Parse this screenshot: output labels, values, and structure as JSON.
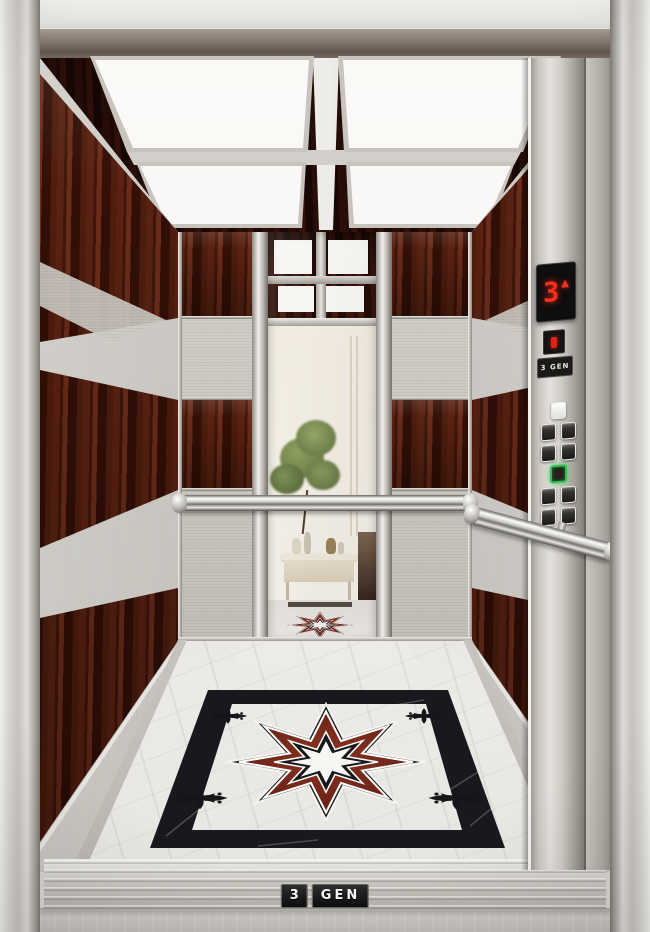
{
  "scene": {
    "description": "Luxury elevator cabin interior: mahogany and textured stainless panels, four-panel ceiling lights, center mirror reflecting a lobby with plant and console table, chrome handrails, marble floor with eight-point star medallion"
  },
  "brand": {
    "name": "3 GEN"
  },
  "cop": {
    "floor_display": {
      "floor": "3",
      "direction": "up",
      "direction_glyph": "▲",
      "color": "#ff2f1d"
    },
    "service_indicator": {
      "color": "#e02218"
    },
    "brand_plate": {
      "label": "3 GEN"
    },
    "buttons": {
      "highlight_color": "#2ec152",
      "layout": [
        "single-lit",
        "pair",
        "pair",
        "single-green",
        "pair",
        "pair"
      ],
      "count": 10
    }
  },
  "threshold": {
    "badge_left": "3",
    "badge_right": "GEN"
  },
  "ceiling": {
    "light_panels": 4
  },
  "handrails": {
    "count": 2
  },
  "floor": {
    "medallion": "eight-point star",
    "materials": [
      "white marble",
      "black marble border",
      "red marble star"
    ]
  },
  "colors": {
    "wood": "#4a1b10",
    "steel": "#c9c5be",
    "chrome": "#e8e8e6",
    "marble_white": "#e9e7e3",
    "marble_black": "#17171a",
    "marble_red": "#6e241a",
    "light_panel": "#f7f6f3",
    "display_red": "#ff2f1d",
    "button_green": "#2ec152"
  }
}
